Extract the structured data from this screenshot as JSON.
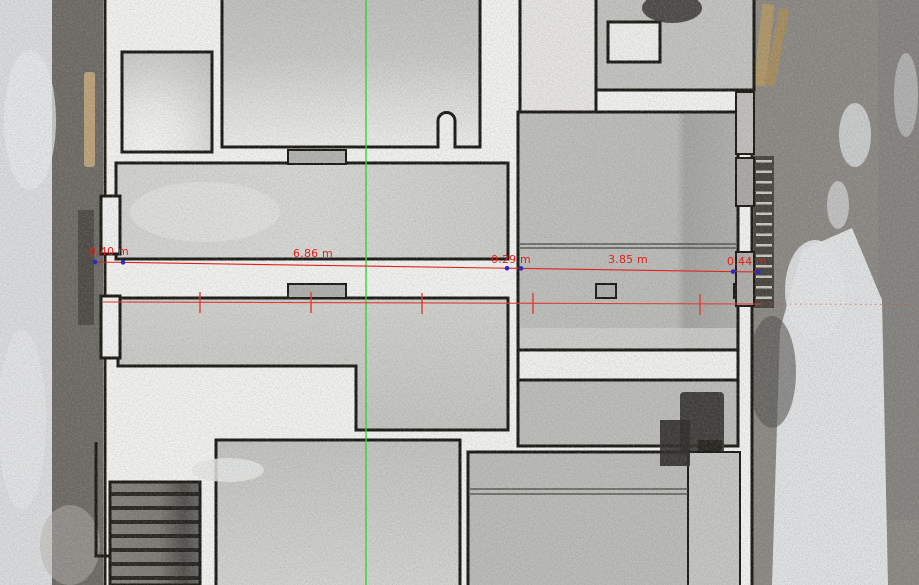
{
  "view": {
    "name": "point-cloud-plan-view",
    "description": "top-down orthographic point cloud of building interior with street on both sides"
  },
  "annotation_colors": {
    "measurement": "#e0211b",
    "section_line": "#e23b34",
    "axis_line": "#2fd32f",
    "vertex_dot": "#2a2ac8"
  },
  "measurements": {
    "unit": "m",
    "segments": [
      {
        "label": "0.40 m",
        "value": 0.4
      },
      {
        "label": "6.86 m",
        "value": 6.86
      },
      {
        "label": "0.29 m",
        "value": 0.29
      },
      {
        "label": "3.85 m",
        "value": 3.85
      },
      {
        "label": "0.44 m",
        "value": 0.44
      }
    ]
  }
}
